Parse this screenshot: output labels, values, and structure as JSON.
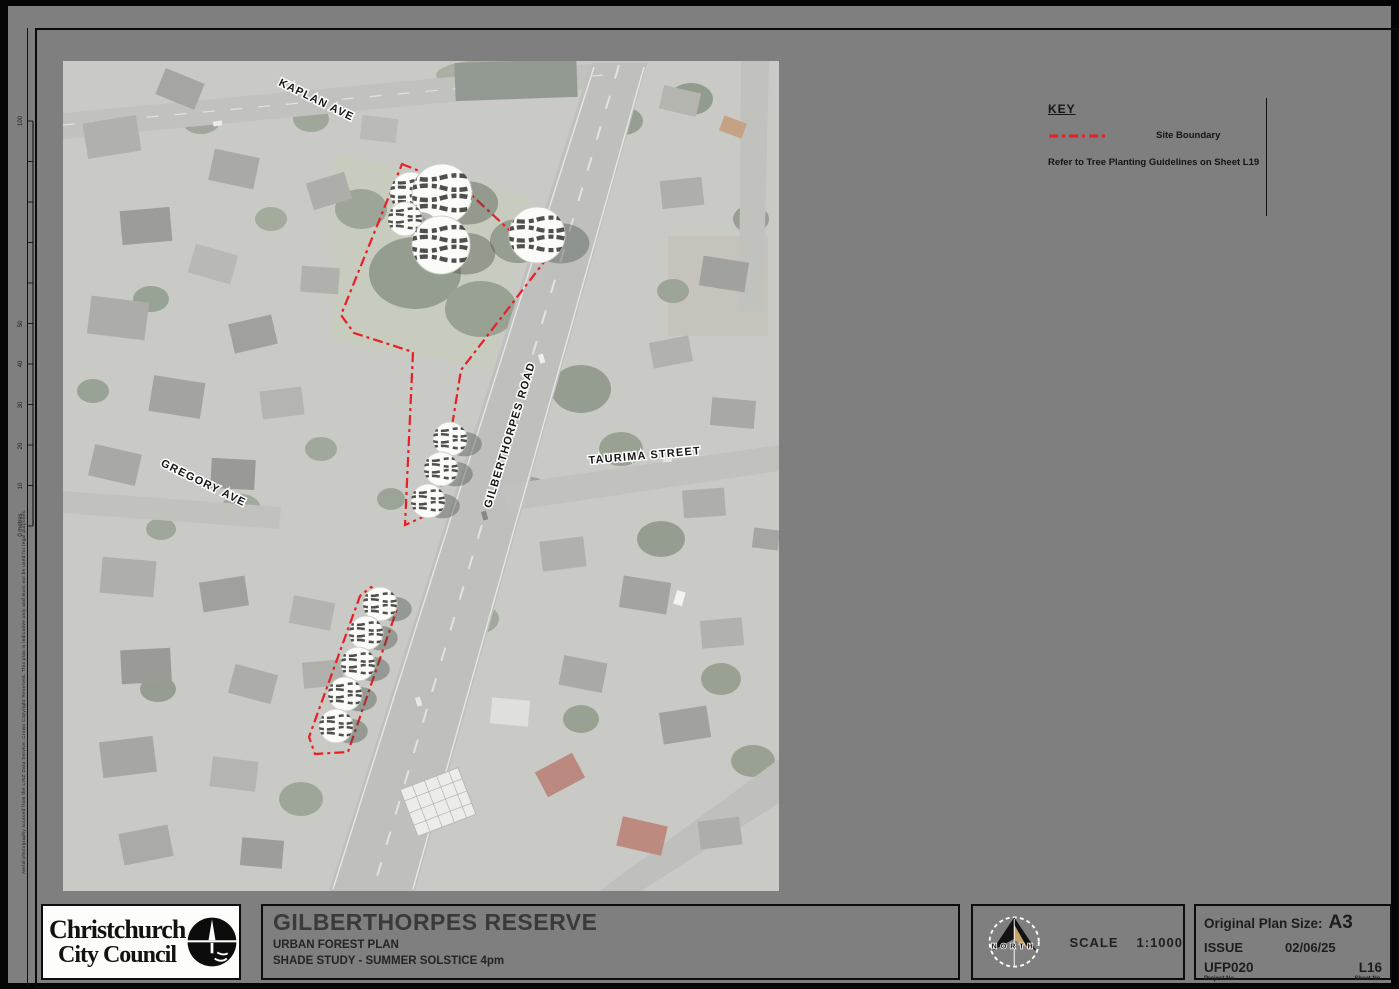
{
  "sheet": {
    "key": {
      "title": "KEY",
      "site_boundary_label": "Site Boundary",
      "note": "Refer to Tree Planting Guidelines on Sheet L19",
      "boundary_color": "#e81f25"
    },
    "logo": {
      "line1": "Christchurch",
      "line2": "City Council"
    },
    "title_block": {
      "title": "GILBERTHORPES RESERVE",
      "subtitle": "URBAN FOREST PLAN",
      "description": "SHADE STUDY - SUMMER SOLSTICE 4pm"
    },
    "north_scale": {
      "north": "NORTH",
      "scale_label": "SCALE",
      "scale_value": "1:1000"
    },
    "plan_info": {
      "size_label": "Original Plan Size:",
      "size": "A3",
      "issue_label": "ISSUE",
      "issue_date": "02/06/25",
      "project_no": "UFP020",
      "project_no_label": "Project No.",
      "sheet_no": "L16",
      "sheet_no_label": "Sheet No."
    },
    "margin": {
      "scalebar_labels": [
        {
          "y": 115,
          "t": "100"
        },
        {
          "y": 318,
          "t": "50"
        },
        {
          "y": 358,
          "t": "40"
        },
        {
          "y": 399,
          "t": "30"
        },
        {
          "y": 440,
          "t": "20"
        },
        {
          "y": 480,
          "t": "10"
        },
        {
          "y": 519,
          "t": "0 metres"
        }
      ],
      "scalebar_top_y": 115,
      "scalebar_bottom_y": 520,
      "fine_print": "Aerial photography sourced from the LINZ Data Service. Crown Copyright Reserved. This plan is indicative only and must not be used for legal purposes."
    }
  },
  "map": {
    "street_labels": [
      {
        "text": "KAPLAN AVE",
        "x": 252,
        "y": 42,
        "angle": 26
      },
      {
        "text": "GILBERTHORPES ROAD",
        "x": 450,
        "y": 375,
        "angle": -73
      },
      {
        "text": "TAURIMA STREET",
        "x": 582,
        "y": 398,
        "angle": -5
      },
      {
        "text": "GREGORY AVE",
        "x": 139,
        "y": 425,
        "angle": 26
      }
    ],
    "trees": [
      {
        "x": 348,
        "y": 132,
        "r": 21
      },
      {
        "x": 379,
        "y": 133,
        "r": 30
      },
      {
        "x": 342,
        "y": 158,
        "r": 17
      },
      {
        "x": 378,
        "y": 184,
        "r": 29
      },
      {
        "x": 474,
        "y": 174,
        "r": 28
      },
      {
        "x": 387,
        "y": 378,
        "r": 17
      },
      {
        "x": 378,
        "y": 408,
        "r": 17
      },
      {
        "x": 365,
        "y": 440,
        "r": 17
      },
      {
        "x": 317,
        "y": 543,
        "r": 17
      },
      {
        "x": 303,
        "y": 572,
        "r": 17
      },
      {
        "x": 295,
        "y": 603,
        "r": 17
      },
      {
        "x": 282,
        "y": 633,
        "r": 17
      },
      {
        "x": 273,
        "y": 665,
        "r": 17
      }
    ],
    "boundary_paths": [
      "339,103 403,129 481,201 398,309 381,415 371,451 342,464 350,291 291,272 278,254",
      "308,526 334,548 285,691 252,693 246,676 297,535"
    ]
  }
}
